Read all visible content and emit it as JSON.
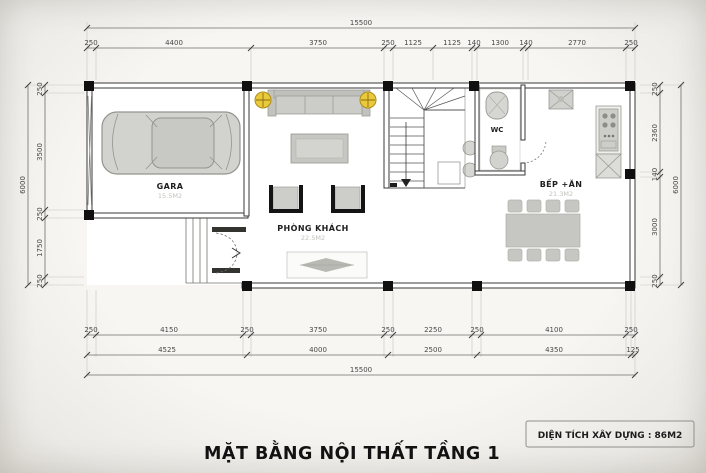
{
  "title": "MẶT BẰNG NỘI THẤT TẦNG 1",
  "info_box": {
    "label": "DIỆN TÍCH XÂY DỰNG : 86M2"
  },
  "rooms": {
    "gara": {
      "name": "GARA",
      "area": "15.5M2"
    },
    "phong_khach": {
      "name": "PHÒNG KHÁCH",
      "area": "22.5M2"
    },
    "wc": {
      "name": "WC"
    },
    "bep_an": {
      "name": "BẾP +ĂN",
      "area": "21.3M2"
    }
  },
  "dimensions": {
    "top_total": "15500",
    "top_segments": [
      "250",
      "4400",
      "3750",
      "250",
      "1125",
      "1125",
      "140",
      "1300",
      "140",
      "2770",
      "250"
    ],
    "bottom_row1": [
      "250",
      "4150",
      "250",
      "3750",
      "250",
      "2250",
      "250",
      "4100",
      "250"
    ],
    "bottom_row2": [
      "4525",
      "4000",
      "2500",
      "4350",
      "125"
    ],
    "bottom_total": "15500",
    "left_segments": [
      "250",
      "3500",
      "250",
      "1750",
      "250"
    ],
    "left_total": "6000",
    "right_segments": [
      "250",
      "2360",
      "140",
      "3000",
      "250"
    ],
    "right_total": "6000"
  },
  "colors": {
    "paper": "#f5f4f1",
    "wall_line": "#3a3a3a",
    "furniture": "#c9c9c5",
    "light_symbol": "#eac93b"
  }
}
